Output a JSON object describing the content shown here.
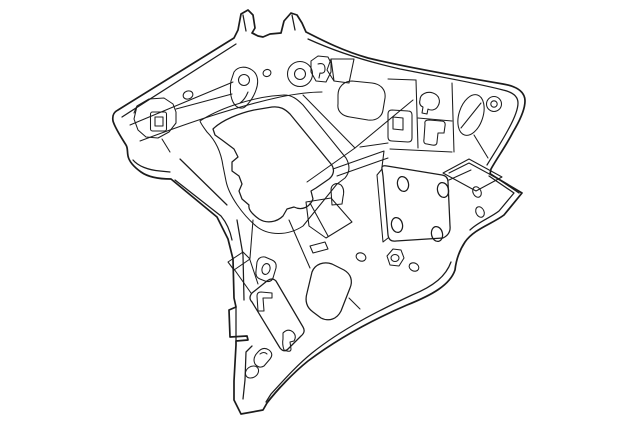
{
  "figure": {
    "description": "Parts-catalog style black-and-white line drawing of an automotive body side inner quarter panel, shown in three-quarter perspective with stamped flanges, a large triangular opening, a square mounting plate with four oval holes, grommet rings, keyhole slots and a pointed lower leg",
    "visible_text": "",
    "style": "technical line art, black outlines on white"
  },
  "colors": {
    "background": "#ffffff",
    "line": "#1c1c1c"
  }
}
